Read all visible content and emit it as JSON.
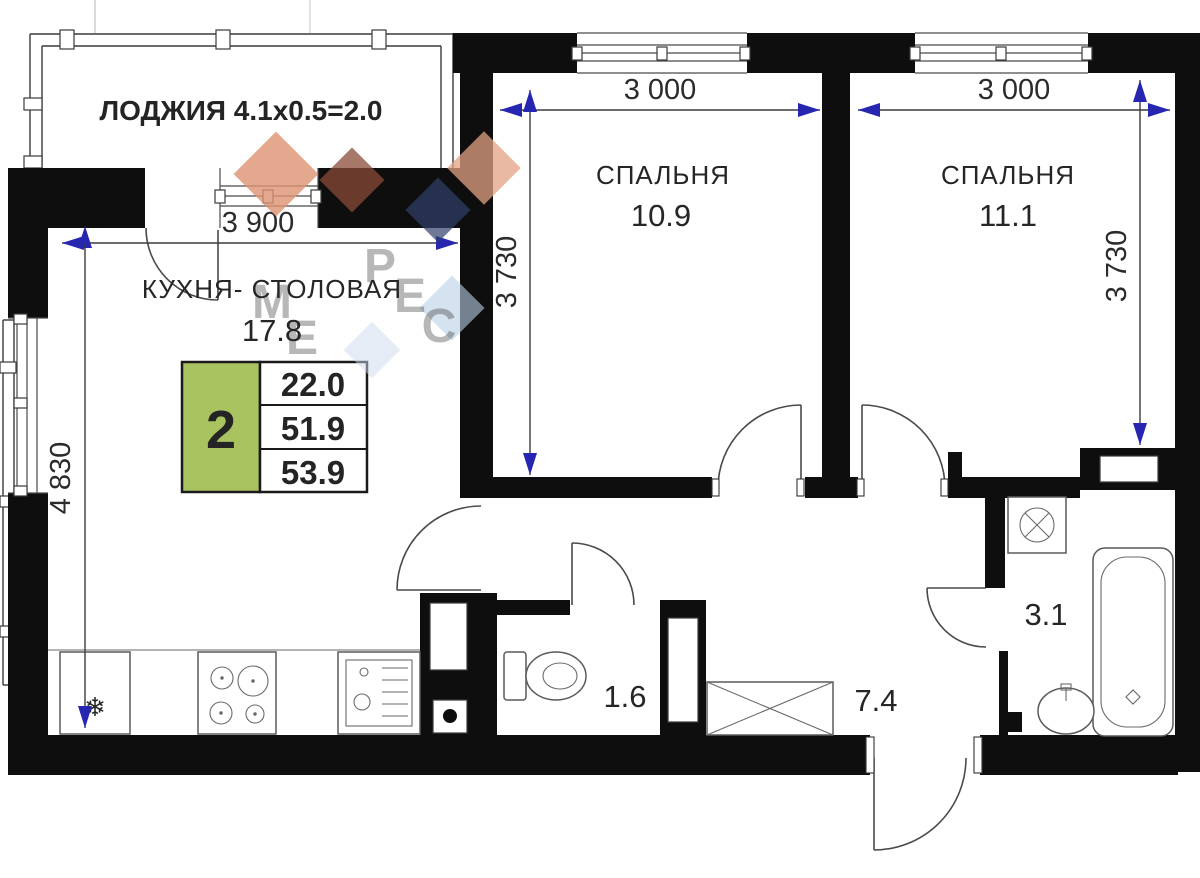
{
  "plan": {
    "loggia": {
      "label": "ЛОДЖИЯ 4.1х0.5=2.0"
    },
    "rooms": {
      "kitchen": {
        "name": "КУХНЯ- СТОЛОВАЯ",
        "area": "17.8"
      },
      "bedroom1": {
        "name": "СПАЛЬНЯ",
        "area": "10.9"
      },
      "bedroom2": {
        "name": "СПАЛЬНЯ",
        "area": "11.1"
      },
      "wc": {
        "area": "1.6"
      },
      "hall": {
        "area": "7.4"
      },
      "bathroom": {
        "area": "3.1"
      }
    },
    "info_table": {
      "rooms_count": "2",
      "values": [
        "22.0",
        "51.9",
        "53.9"
      ],
      "green_color": "#a9c361"
    },
    "dimensions": {
      "kitchen_width": "3 900",
      "kitchen_height": "4 830",
      "bedroom1_width": "3 000",
      "bedroom1_height": "3 730",
      "bedroom2_width": "3 000",
      "bedroom2_height": "3 730"
    },
    "watermark": {
      "letters": [
        "М",
        "Е",
        "Р",
        "Е",
        "С"
      ],
      "text_color": "#3a63a8",
      "diamond_orange": "#dd9272",
      "diamond_navy": "#31406b",
      "diamond_blue": "#b9cfe4"
    },
    "icons": {
      "fridge_glyph": "❄"
    },
    "colors": {
      "wall": "#0e0e0e",
      "dimension_arrow": "#2626b0"
    }
  }
}
